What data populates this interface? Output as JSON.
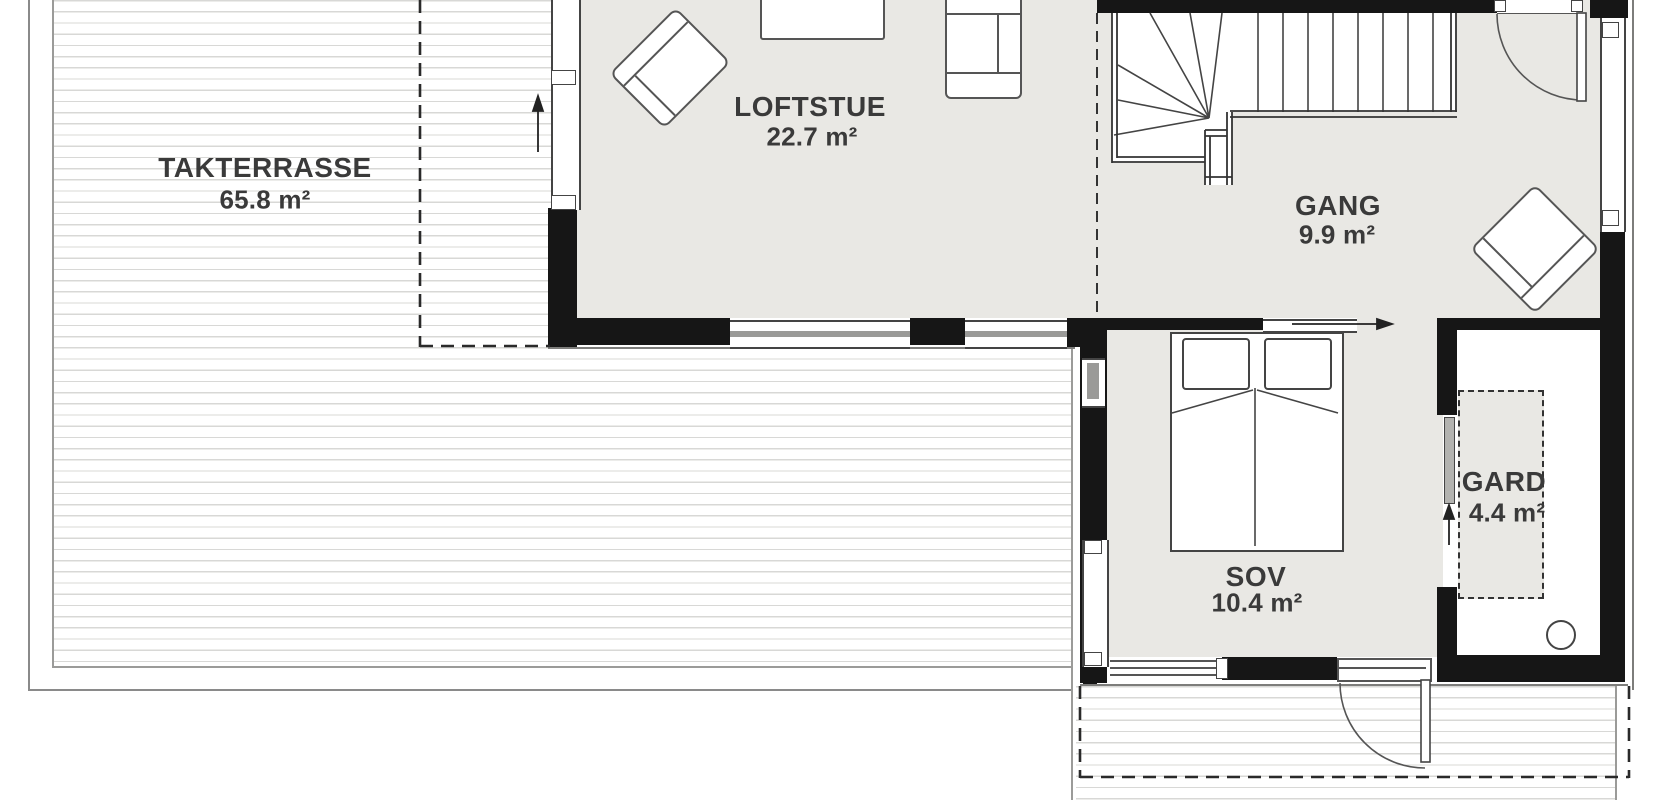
{
  "plan": {
    "type": "architectural-floor-plan",
    "rooms": [
      {
        "id": "takterrasse",
        "name": "TAKTERRASSE",
        "area": "65.8 m²"
      },
      {
        "id": "loftstue",
        "name": "LOFTSTUE",
        "area": "22.7 m²"
      },
      {
        "id": "gang",
        "name": "GANG",
        "area": "9.9 m²"
      },
      {
        "id": "sov",
        "name": "SOV",
        "area": "10.4 m²"
      },
      {
        "id": "gard",
        "name": "GARD",
        "area": "4.4 m²"
      }
    ],
    "features": {
      "stairs": "winder-staircase",
      "doors": [
        "swing-door-gang-north",
        "swing-door-sov-south",
        "sliding-door-sov-north",
        "pocket-door-gard-west"
      ],
      "arrows": [
        "slide-direction-up-west-terrace",
        "slide-direction-right-sov",
        "slide-direction-up-gard"
      ],
      "fixtures": [
        "double-bed",
        "armchair-loftstue",
        "armchair-gang",
        "chair-loftstue-north",
        "side-table",
        "floor-drain-circle",
        "wardrobe-dashed"
      ]
    },
    "colors": {
      "floor": "#e9e8e4",
      "wall": "#161616",
      "furniture_line": "#555555",
      "deck_line": "#d8d8d6",
      "text": "#3a3a3a"
    }
  }
}
